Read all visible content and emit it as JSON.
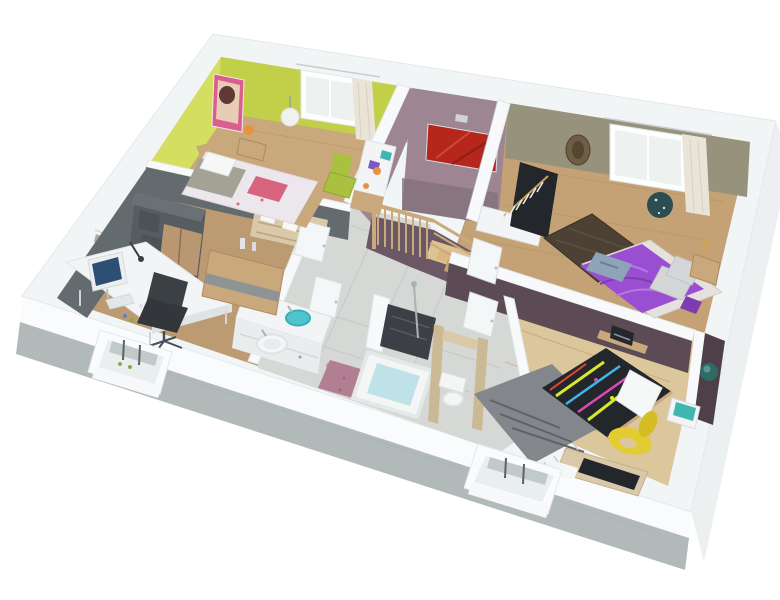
{
  "meta": {
    "title": "3D isometric cutaway floor plan render of a one-storey home",
    "view": "dollhouse aerial perspective, white cutaway walls with concrete slab edge",
    "visible_text": []
  },
  "palette": {
    "bg": "#ffffff",
    "band": "#f2f5f6",
    "band_line": "#e3e8ea",
    "face_sw": "#fafbfc",
    "slab": "#b2b9b9",
    "face_se": "#edf0f1",
    "wood": "#c9a87c",
    "wood_office": "#bd9b72",
    "wood_master": "#c4a276",
    "wood_kids": "#dcc69b",
    "plank": "#b28e61",
    "tile": "#d5d8d5",
    "tile_line": "#c4c8c6",
    "green_lit": "#d4de5f",
    "green": "#c2cf49",
    "mauve": "#9d8692",
    "mauve_dark": "#84707c",
    "mauve_deep": "#6c5864",
    "olive": "#96927b",
    "olive_lit": "#a3a089",
    "plum": "#5c4a55",
    "plum_dark": "#4e3f49",
    "gray_wall": "#646b6f",
    "white_wall": "#f7f9fa",
    "door": "#f4f7f8",
    "door_edge": "#d9dfe1",
    "red_art": "#b5271d",
    "red_art_lit": "#d04a33",
    "pink_art": "#d95f8e",
    "art_skin": "#e8cdb6",
    "art_hair": "#5f3a34",
    "duvet1": "#ece7ec",
    "blanket1": "#a3a295",
    "pillow_pink": "#d8637f",
    "pillow_white": "#f6f7f7",
    "wood_furn": "#c9a87b",
    "purple": "#9a4fd2",
    "purple_lit": "#b877e6",
    "purple_dark": "#7e3cb0",
    "rug_master": "#4d4136",
    "rug_pink": "#b27e91",
    "rug_gray": "#83868a",
    "rug_gray_dark": "#5f6266",
    "teal": "#4ec5cd",
    "teal_dark": "#37aeb8",
    "water": "#bfe2e8",
    "fixture": "#f4f6f6",
    "fixture_shade": "#dde2e3",
    "yellow_chair": "#e2cc31",
    "yellow_chair_dark": "#d4be24",
    "green_chair": "#aac13f",
    "desk_white": "#f2f4f5",
    "desk_edge": "#dfe3e4",
    "cab_gray": "#565c60",
    "cab_gray_top": "#6a7074",
    "cab_wood": "#b99771",
    "sideboard_band": "#8e9496",
    "curtain": "#eae4d8",
    "glass": "#eef1f0",
    "frame": "#fdfefe",
    "dark": "#23262a",
    "screen": "#2e4f74",
    "monitor_frame": "#eceff0",
    "chair_back": "#3b4044",
    "chair_seat": "#33373b",
    "stair_wood": "#c8aa7c",
    "stair_glow": "#e9cf96",
    "step1": "#dab77f",
    "step2": "#c6a06a",
    "step3": "#a87f52",
    "beige": "#cbb894",
    "shelf_beige": "#d9c9a9",
    "shower": "#3c4046",
    "shower_lit": "#565b62",
    "metal": "#aab2b5",
    "neon_y": "#d8e82c",
    "neon_b": "#3fb7e8",
    "neon_p": "#e048b8",
    "neon_r": "#e04838",
    "jeans": "#8fa3b8",
    "pillow_gray": "#d4d6d8",
    "brass": "#c9a35a",
    "orange": "#e8923f",
    "mask": "#6f5d45",
    "disc": "#2c4d52",
    "radio": "#23272b",
    "poster_teal": "#2e6b66",
    "poster_glow": "#58968f",
    "aqua": "#3fb7b0",
    "violet_item": "#7e57c4",
    "bed_base": "#e5e2de",
    "switch": "#8f979a",
    "plant": "#7fae4a"
  },
  "rooms": [
    {
      "id": "bedroom-child",
      "label": "child bedroom",
      "wall_color_key": "green",
      "furniture": [
        "double bed with floral duvet",
        "grey throw",
        "pink cushion",
        "white pillows",
        "nightstand with orange lamp",
        "globe pendant light",
        "pink portrait art",
        "window with cream curtain",
        "white desk with books",
        "green chair"
      ]
    },
    {
      "id": "stair-hall",
      "label": "stair hall",
      "wall_color_key": "mauve",
      "furniture": [
        "wood staircase",
        "baluster railing",
        "red abstract painting",
        "wall sconce",
        "tiled landing"
      ]
    },
    {
      "id": "master-bedroom",
      "label": "master bedroom",
      "wall_color_key": "olive",
      "furniture": [
        "bed with purple satin duvet",
        "jeans on bed",
        "grey pillows",
        "dark woven rug",
        "open wardrobe with white hangers",
        "nightstand with brass lamp",
        "african mask decor",
        "dark disc decor",
        "window with white curtain"
      ]
    },
    {
      "id": "office",
      "label": "home office",
      "wall_color_key": "gray_wall",
      "furniture": [
        "white corner desk",
        "monitor",
        "desk lamp",
        "keyboard",
        "black office chair",
        "grey wardrobe with wood doors",
        "curved wood sideboard",
        "two vases",
        "window recess"
      ]
    },
    {
      "id": "bathroom",
      "label": "bathroom",
      "wall_color_key": "white_wall",
      "furniture": [
        "double vanity",
        "teal glass bowl sink",
        "white round basin",
        "mirror",
        "bathtub with water",
        "dark tiled walk-in shower",
        "rose rug"
      ]
    },
    {
      "id": "wc",
      "label": "wc",
      "wall_color_key": "beige",
      "furniture": [
        "toilet",
        "beige partitions"
      ]
    },
    {
      "id": "teen-bedroom",
      "label": "teen bedroom",
      "wall_color_key": "plum",
      "furniture": [
        "bed with neon graffiti duvet",
        "white pillow",
        "grey fringed rug",
        "yellow sculpted chair",
        "desk",
        "wall shelf with radio",
        "aquarium table",
        "teal poster",
        "window recess"
      ]
    }
  ],
  "structure": {
    "exterior": "white cutaway walls on grey concrete slab edge",
    "windows": [
      "child bedroom window (NE wall)",
      "master bedroom window (NE wall)",
      "office window recess (SW wall)",
      "teen bedroom window recess (SW wall)"
    ]
  }
}
